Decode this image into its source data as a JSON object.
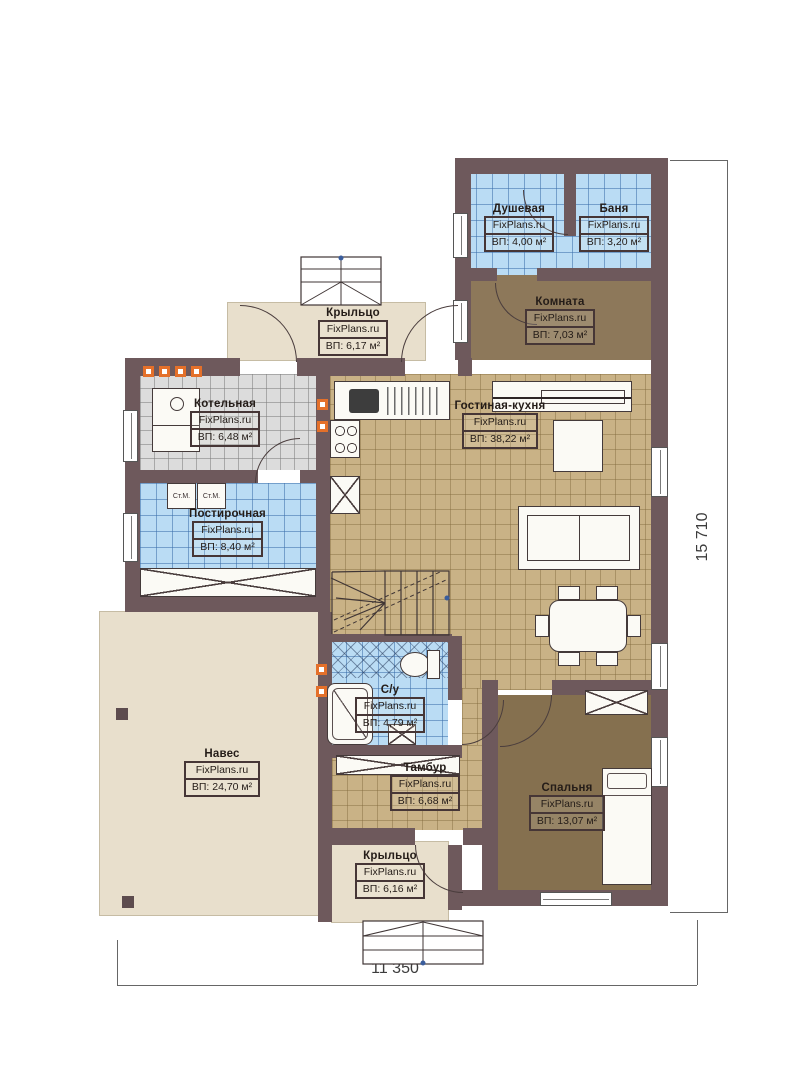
{
  "rooms": [
    {
      "id": "dushevaya",
      "name": "Душевая",
      "brand": "FixPlans.ru",
      "area": "ВП: 4,00 м²"
    },
    {
      "id": "banya",
      "name": "Баня",
      "brand": "FixPlans.ru",
      "area": "ВП: 3,20 м²"
    },
    {
      "id": "komnata",
      "name": "Комната",
      "brand": "FixPlans.ru",
      "area": "ВП: 7,03 м²"
    },
    {
      "id": "kryltso-top",
      "name": "Крыльцо",
      "brand": "FixPlans.ru",
      "area": "ВП: 6,17 м²"
    },
    {
      "id": "kotelnaya",
      "name": "Котельная",
      "brand": "FixPlans.ru",
      "area": "ВП: 6,48 м²"
    },
    {
      "id": "gostinaya",
      "name": "Гостиная-кухня",
      "brand": "FixPlans.ru",
      "area": "ВП: 38,22 м²"
    },
    {
      "id": "postirochnaya",
      "name": "Постирочная",
      "brand": "FixPlans.ru",
      "area": "ВП: 8,40 м²"
    },
    {
      "id": "naves",
      "name": "Навес",
      "brand": "FixPlans.ru",
      "area": "ВП: 24,70 м²"
    },
    {
      "id": "su",
      "name": "С/у",
      "brand": "FixPlans.ru",
      "area": "ВП: 4,79 м²"
    },
    {
      "id": "tambur",
      "name": "Тамбур",
      "brand": "FixPlans.ru",
      "area": "ВП: 6,68 м²"
    },
    {
      "id": "spalnya",
      "name": "Спальня",
      "brand": "FixPlans.ru",
      "area": "ВП: 13,07 м²"
    },
    {
      "id": "kryltso-bottom",
      "name": "Крыльцо",
      "brand": "FixPlans.ru",
      "area": "ВП: 6,16 м²"
    }
  ],
  "appliances": {
    "washer1": "Ст.М.",
    "washer2": "Ст.М."
  },
  "dimensions": {
    "height_total": "15 710",
    "width_total": "11 350"
  },
  "colors": {
    "wall": "#6e595c",
    "tile_blue": "#badcf4",
    "tile_gray": "#dcdcdc",
    "tile_tan": "#c9b286",
    "floor_brown": "#8d785a",
    "floor_beige": "#e8dfcc",
    "vent_orange": "#e4702a"
  }
}
